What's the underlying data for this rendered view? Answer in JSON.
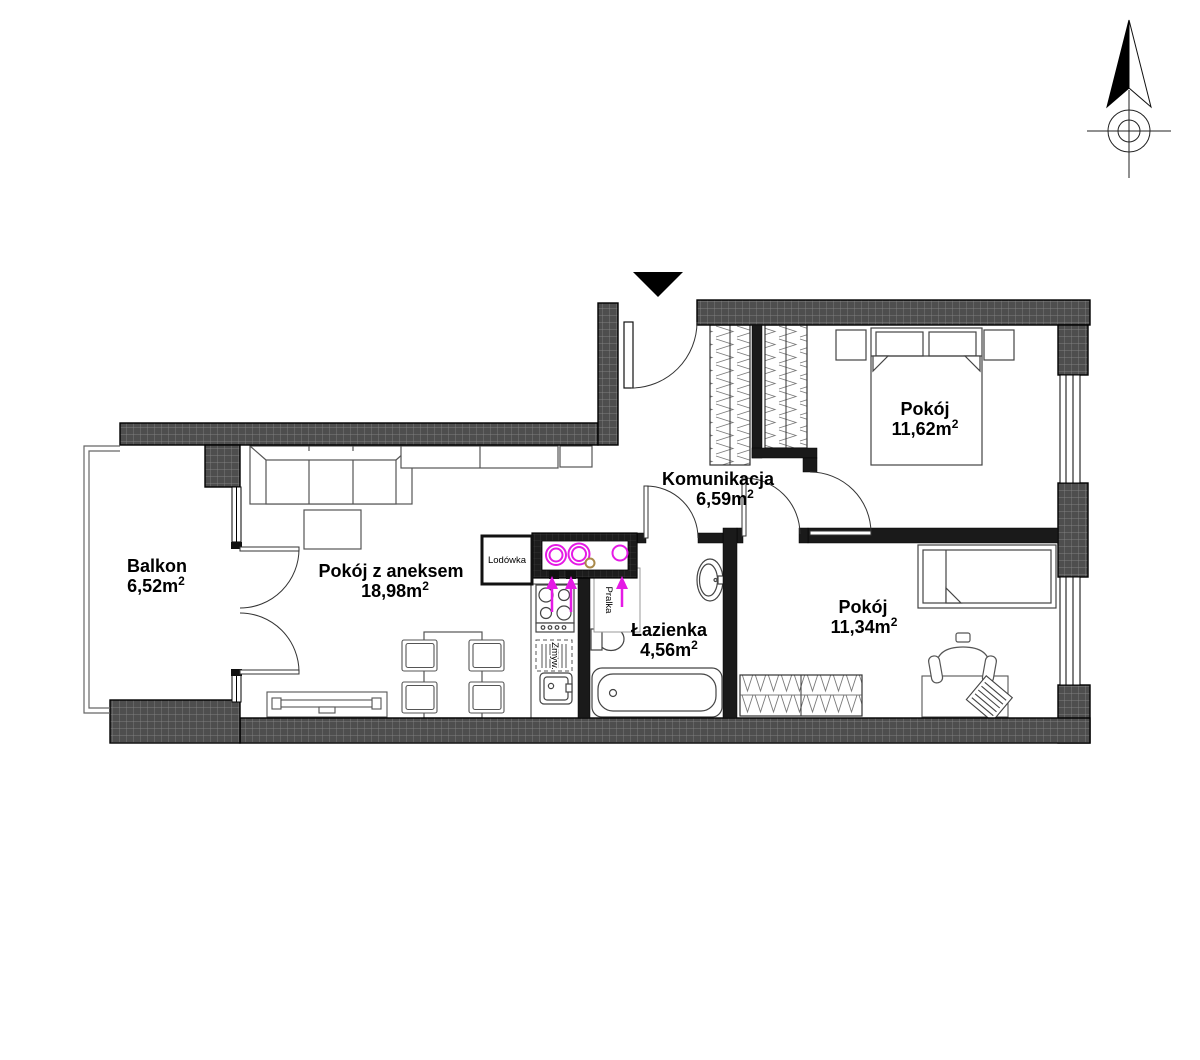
{
  "floor_plan": {
    "rooms": [
      {
        "name": "Balkon",
        "area": "6,52m2"
      },
      {
        "name": "Pokój z aneksem",
        "area": "18,98m2"
      },
      {
        "name": "Komunikacja",
        "area": "6,59m2"
      },
      {
        "name": "Łazienka",
        "area": "4,56m2"
      },
      {
        "name": "Pokój",
        "area": "11,62m2"
      },
      {
        "name": "Pokój",
        "area": "11,34m2"
      }
    ],
    "appliances": {
      "fridge": "Lodówka",
      "washing_machine": "Pralka",
      "dishwasher": "Zmyw."
    },
    "colors": {
      "wall_fill": "#4e4e4e",
      "partition": "#1a1a1a",
      "utility_accent": "#e51ae5",
      "gas_point": "#a9894a"
    },
    "icons": {
      "north_arrow": "north-arrow",
      "entrance": "entrance-marker"
    }
  }
}
